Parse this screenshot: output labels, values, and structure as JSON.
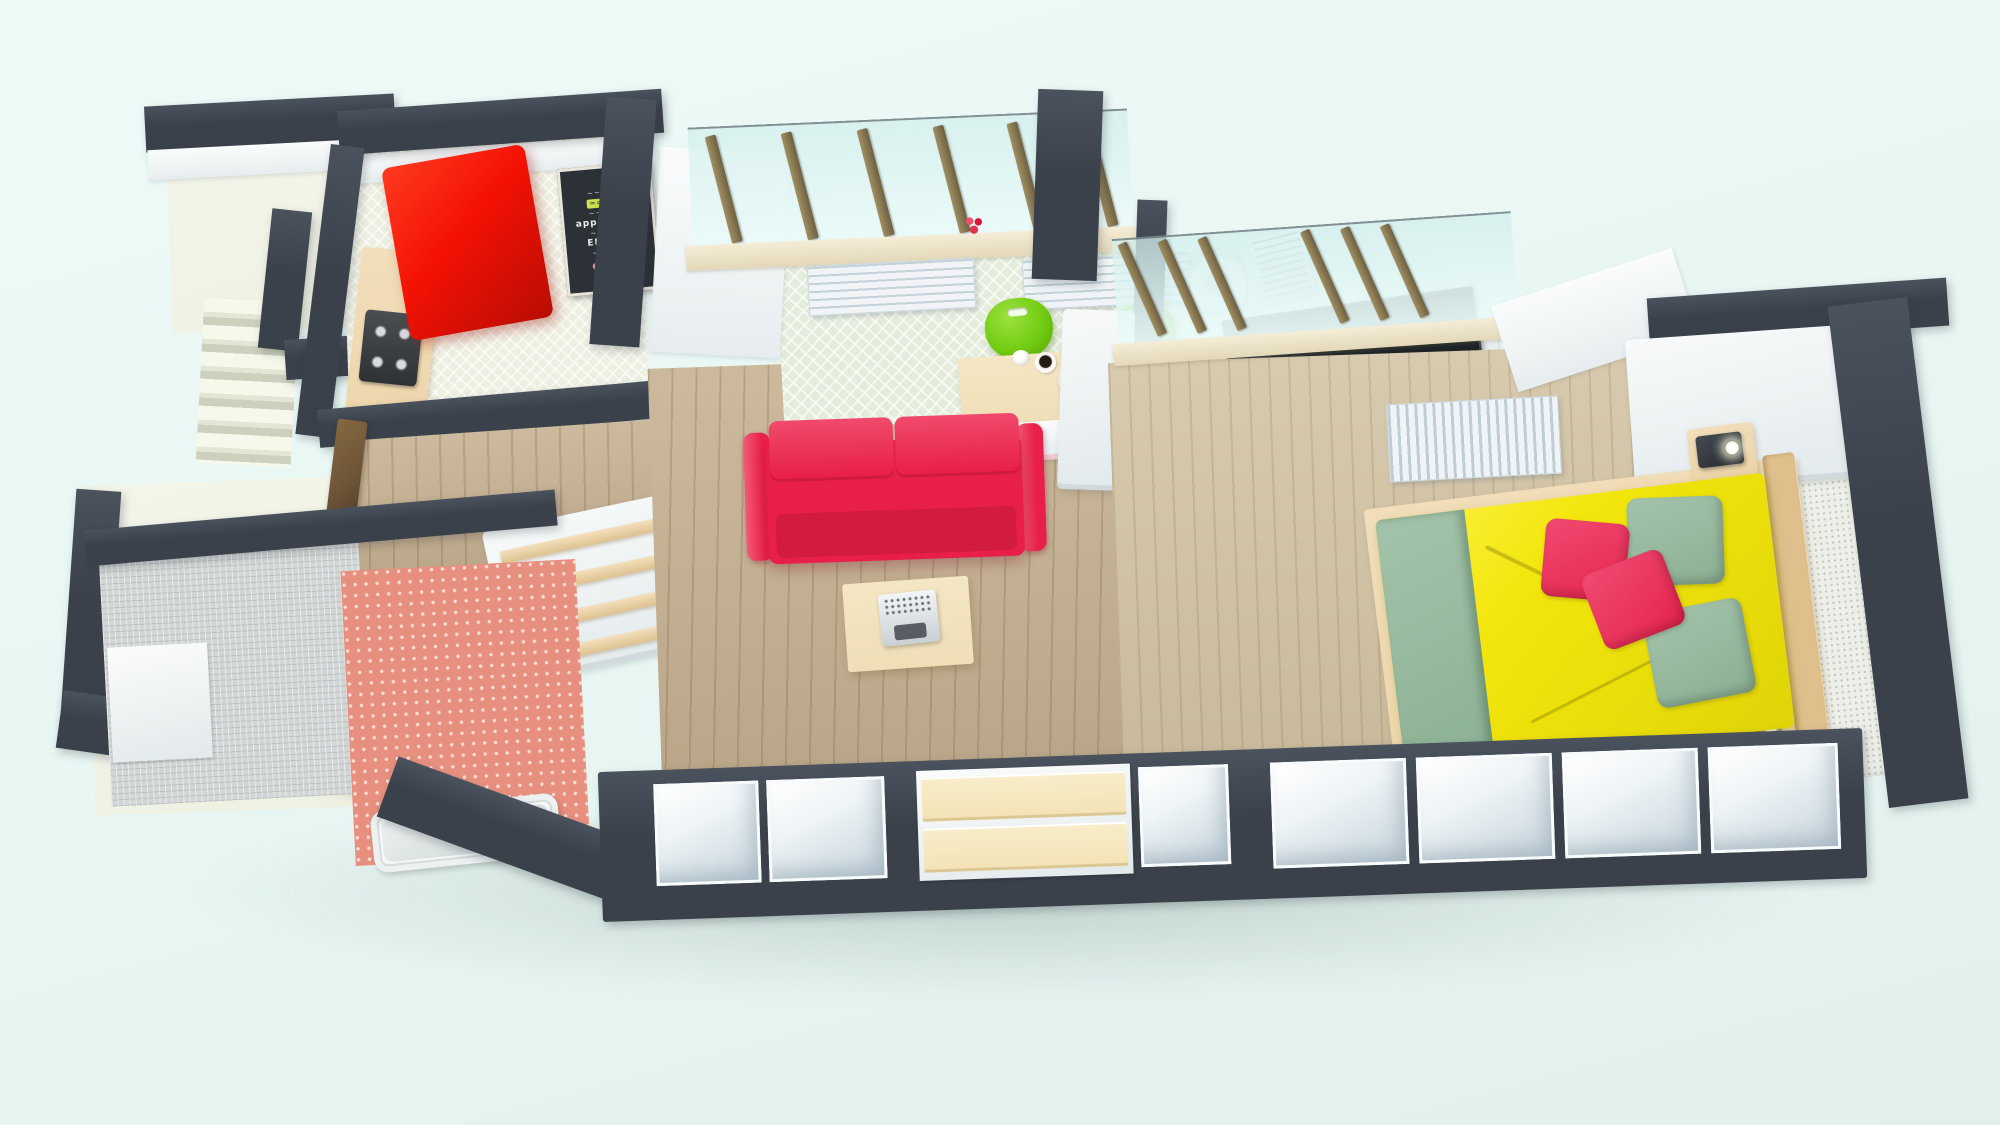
{
  "scene": {
    "type": "3d-floor-plan-render",
    "view": "top-down perspective render of a one-bedroom apartment",
    "palette": {
      "background_top": "#edfaf7",
      "background_bottom": "#e1f0ed",
      "wall": "#3a414b",
      "wall_highlight": "#4a525d",
      "ivory": "#eef1e2",
      "kitchen_floor": "#edefe0",
      "mint_floor": "#e4ecdb",
      "wood_floor": "#c7b191",
      "bedroom_floor": "#d3c3a3",
      "closet_wood": "#f3e2b4",
      "table_wood": "#efdeb6",
      "sofa_red": "#e81f49",
      "sofa_red_dark": "#cf1a3f",
      "fridge_red": "#f31104",
      "bed_yellow": "#f3e60c",
      "sage": "#8cb093",
      "pillow_crimson": "#e6234e",
      "chair_green": "#72cc12",
      "radiator": "#f0f4f6",
      "rug": "#edefe8",
      "mosaic": "#d2d6d6",
      "coral": "#e8907f",
      "door_brown": "#6f5639",
      "frame_tan": "#ecd3a6",
      "chalkboard": "#2b3136",
      "chalk_text": "#cdd3cf",
      "chalk_highlight": "#cde24e",
      "lamp_dark": "#23282c",
      "glass": "#eef9f7",
      "sill": "#efe6cc",
      "mullion": "#8a7a55"
    },
    "rooms": [
      {
        "name": "stairwell",
        "items": [
          "exterior-stairs",
          "landings",
          "parapet-walls",
          "entrance-door"
        ]
      },
      {
        "name": "kitchen",
        "items": [
          "refrigerator",
          "gas-stove",
          "counter",
          "chalkboard-menu",
          "oil-bottle"
        ]
      },
      {
        "name": "hallway",
        "items": [
          "entry-door",
          "bathroom-door",
          "trimmed-wardrobe",
          "wood-floor"
        ]
      },
      {
        "name": "bathroom",
        "items": [
          "mosaic-floor",
          "coral-wallpaper",
          "bathtub",
          "washing-area"
        ]
      },
      {
        "name": "living-room",
        "items": [
          "window-band",
          "radiators",
          "windowsill-flower",
          "dining-table",
          "green-chairs",
          "berry-plate",
          "coffee-cup",
          "sugar-bowl",
          "envelope",
          "red-sofa",
          "coffee-table",
          "typewriter",
          "desk",
          "laptop",
          "paper-trays",
          "ornate-decor",
          "open-closets",
          "drawer-unit"
        ]
      },
      {
        "name": "bedroom",
        "items": [
          "window-band",
          "vertical-radiator",
          "wardrobe",
          "double-bed",
          "sage-pillows",
          "crimson-pillows",
          "nightstands",
          "lamps",
          "knit-rug",
          "open-closets"
        ]
      }
    ]
  },
  "chalkboard": {
    "lines": [
      "~~ ~~~",
      "=====",
      "~~~ ~~",
      "appleberry",
      "~~ ~~~",
      "ERASER",
      "~~~~ ~"
    ]
  }
}
